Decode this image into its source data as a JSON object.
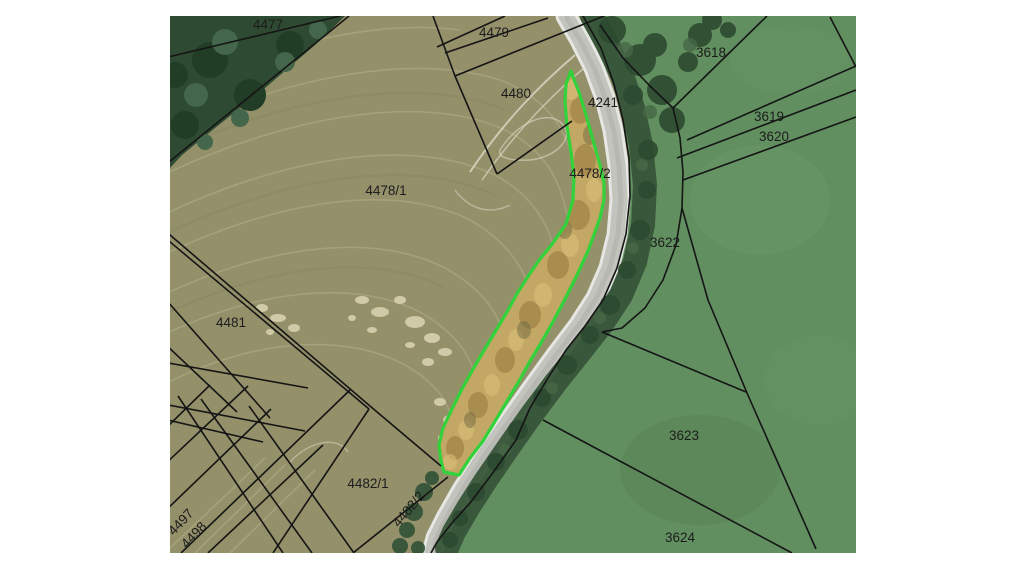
{
  "map": {
    "highlighted_parcel": {
      "number": "4478/2",
      "outline_color": "#32d23a",
      "fill_appearance": "dry-scrub-tan"
    },
    "colors": {
      "field_west_olive": "#93906a",
      "field_east_green": "#628f60",
      "road_gray": "#c3c4be",
      "forest_dark_green": "#2e4a32",
      "boundary_black": "#151515",
      "highlight_green": "#32d23a"
    },
    "parcel_labels": [
      {
        "text": "4477",
        "x": 268,
        "y": 29,
        "rotation": 0
      },
      {
        "text": "4479",
        "x": 494,
        "y": 37,
        "rotation": 0
      },
      {
        "text": "4480",
        "x": 516,
        "y": 98,
        "rotation": 0
      },
      {
        "text": "4241",
        "x": 603,
        "y": 107,
        "rotation": 0
      },
      {
        "text": "4478/1",
        "x": 386,
        "y": 195,
        "rotation": 0
      },
      {
        "text": "4478/2",
        "x": 590,
        "y": 178,
        "rotation": 0,
        "color": "#4a522b"
      },
      {
        "text": "3618",
        "x": 711,
        "y": 57,
        "rotation": 0
      },
      {
        "text": "3619",
        "x": 769,
        "y": 121,
        "rotation": 0
      },
      {
        "text": "3620",
        "x": 774,
        "y": 141,
        "rotation": 0
      },
      {
        "text": "3622",
        "x": 665,
        "y": 247,
        "rotation": 0
      },
      {
        "text": "4481",
        "x": 231,
        "y": 327,
        "rotation": 0
      },
      {
        "text": "3",
        "x": 166,
        "y": 341,
        "rotation": 0
      },
      {
        "text": "3623",
        "x": 684,
        "y": 440,
        "rotation": 0
      },
      {
        "text": "3624",
        "x": 680,
        "y": 542,
        "rotation": 0
      },
      {
        "text": "4482/1",
        "x": 368,
        "y": 488,
        "rotation": 0
      },
      {
        "text": "4482/2",
        "x": 412,
        "y": 512,
        "rotation": -50
      },
      {
        "text": "4497",
        "x": 184,
        "y": 525,
        "rotation": -47
      },
      {
        "text": "4498",
        "x": 197,
        "y": 538,
        "rotation": -47
      }
    ]
  }
}
